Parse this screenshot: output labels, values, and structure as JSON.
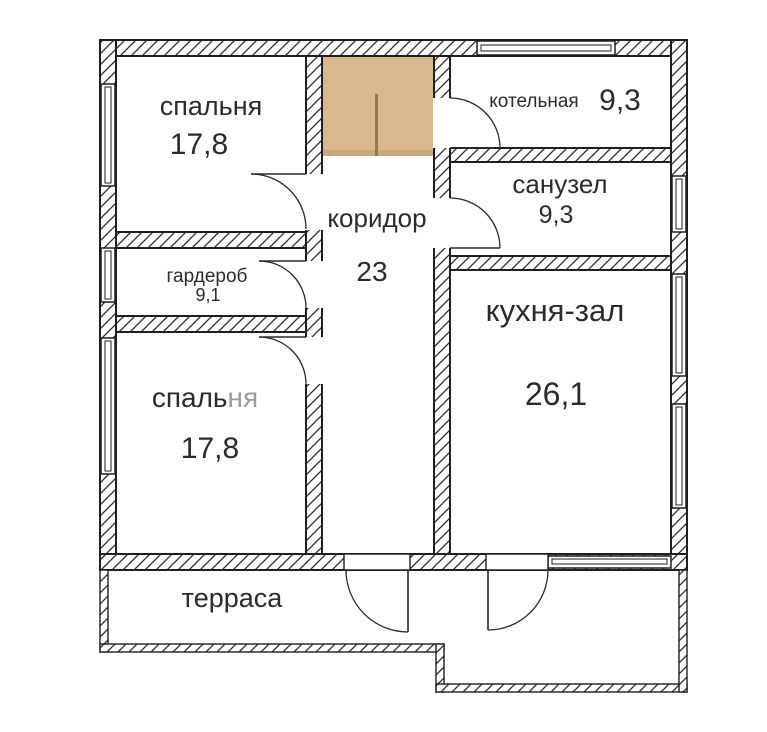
{
  "plan": {
    "type": "floor-plan",
    "rooms": {
      "bedroom1": {
        "name": "спальня",
        "area": "17,8"
      },
      "boiler": {
        "name": "котельная",
        "area": "9,3"
      },
      "bathroom": {
        "name": "санузел",
        "area": "9,3"
      },
      "corridor": {
        "name": "коридор",
        "area": "23"
      },
      "wardrobe": {
        "name": "гардероб",
        "area": "9,1"
      },
      "bedroom2": {
        "name": "спальня",
        "name_part1": "спаль",
        "name_part2": "ня",
        "area": "17,8"
      },
      "kitchen": {
        "name": "кухня-зал",
        "area": "26,1"
      },
      "terrace": {
        "name": "терраса"
      }
    },
    "colors": {
      "wall_line": "#1f1f1f",
      "entry_fill": "#d8b88c",
      "entry_shade": "#c9a97d",
      "entry_divider": "#8d7b60",
      "text": "#2b2b2b",
      "text_faded": "#9b9b9b",
      "background": "#ffffff"
    }
  }
}
